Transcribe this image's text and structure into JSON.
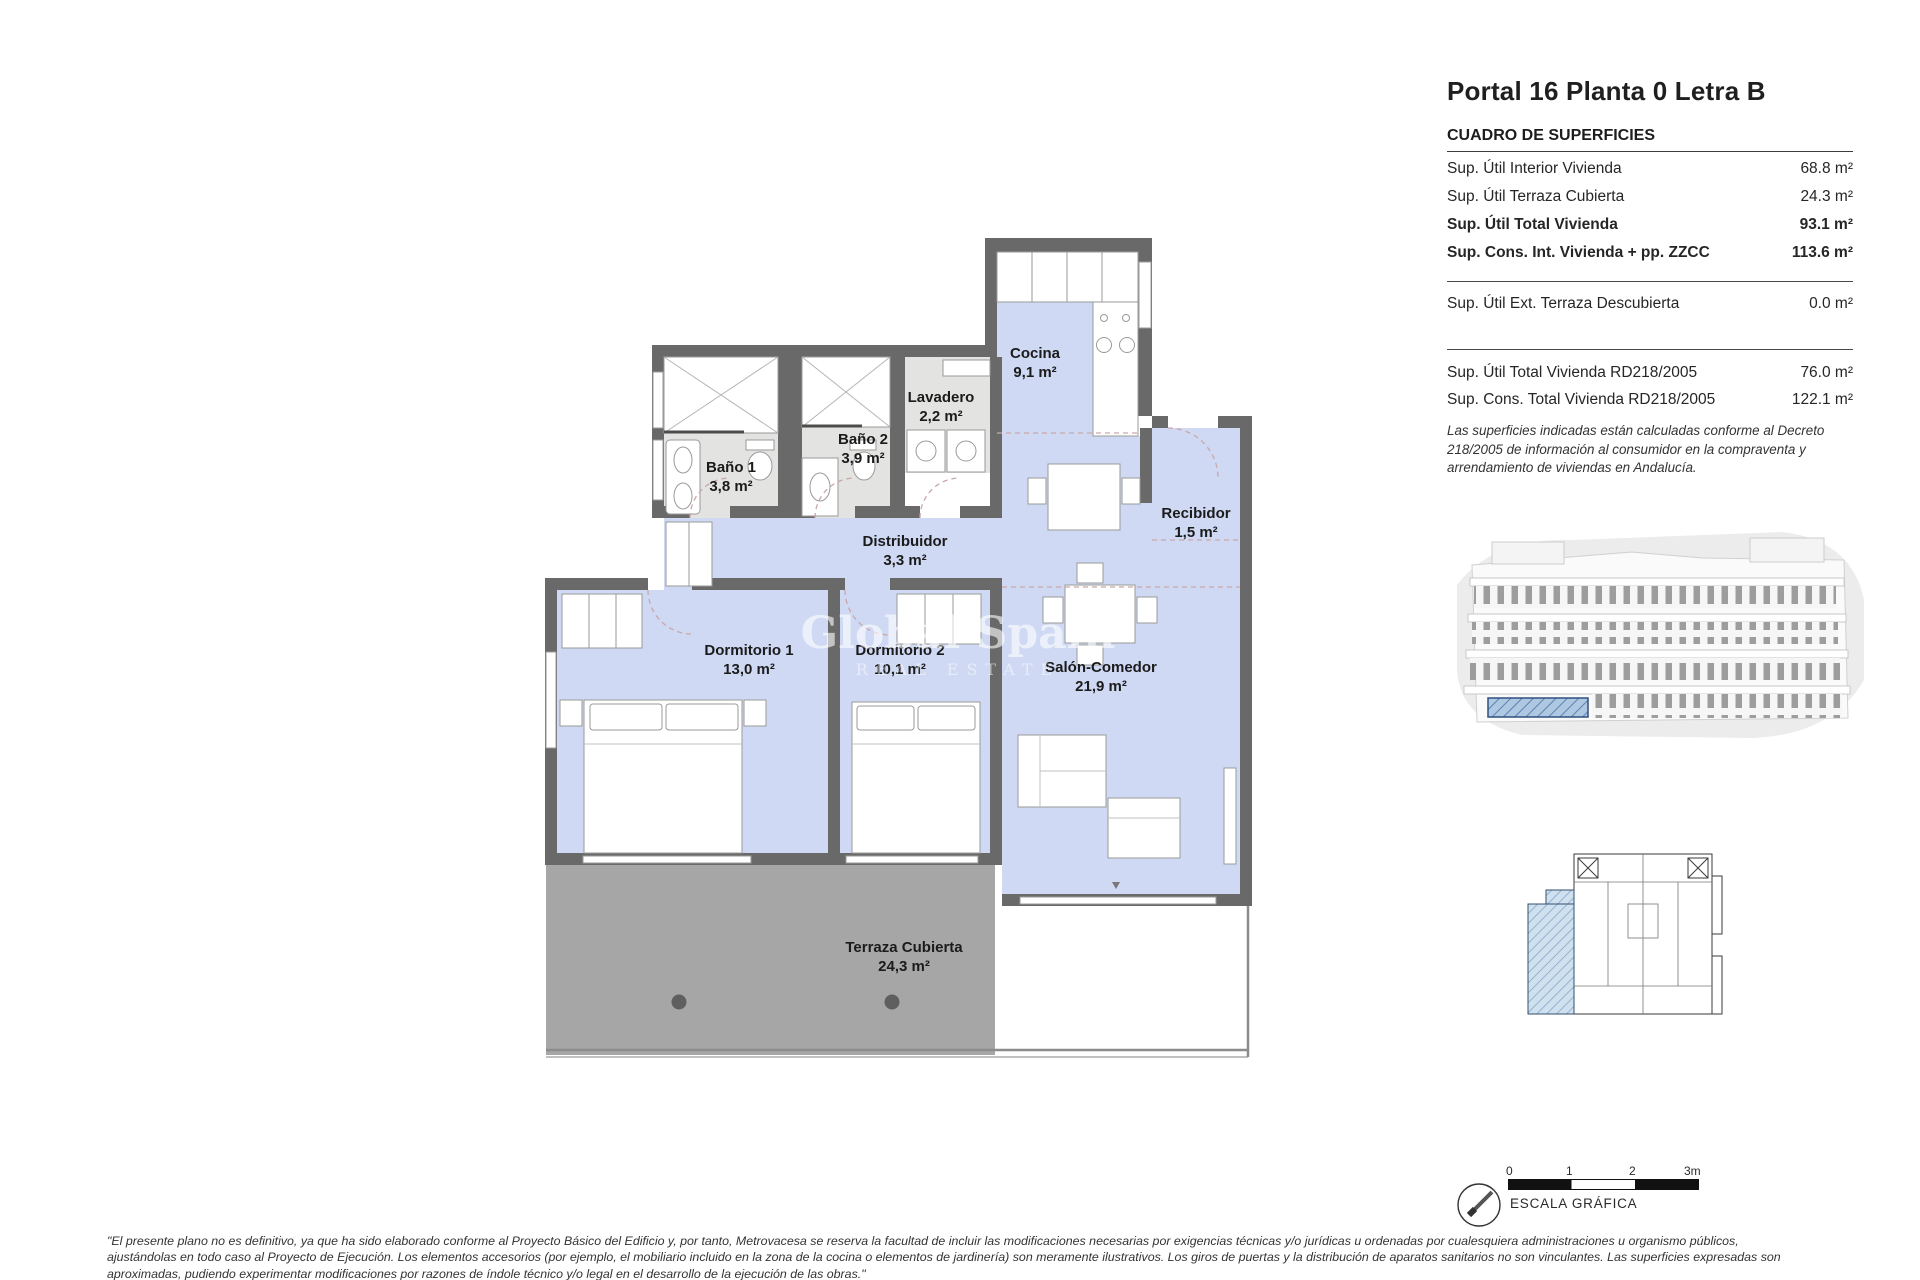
{
  "header": {
    "title": "Portal 16 Planta 0 Letra B"
  },
  "surfaces": {
    "heading": "CUADRO DE SUPERFICIES",
    "rows": [
      {
        "label": "Sup. Útil Interior Vivienda",
        "value": "68.8 m²"
      },
      {
        "label": "Sup. Útil Terraza Cubierta",
        "value": "24.3 m²"
      },
      {
        "label": "Sup. Útil Total Vivienda",
        "value": "93.1 m²"
      },
      {
        "label": "Sup. Cons. Int. Vivienda + pp. ZZCC",
        "value": "113.6 m²"
      }
    ],
    "ext_row": {
      "label": "Sup. Útil Ext. Terraza Descubierta",
      "value": "0.0 m²"
    },
    "rd_rows": [
      {
        "label": "Sup. Útil Total Vivienda RD218/2005",
        "value": "76.0 m²"
      },
      {
        "label": "Sup. Cons. Total Vivienda RD218/2005",
        "value": "122.1 m²"
      }
    ],
    "note": "Las superficies indicadas están calculadas conforme al Decreto 218/2005 de información al consumidor en la compraventa y arrendamiento de viviendas en Andalucía."
  },
  "plan": {
    "rooms": [
      {
        "name": "Cocina",
        "area": "9,1 m²"
      },
      {
        "name": "Lavadero",
        "area": "2,2 m²"
      },
      {
        "name": "Baño 1",
        "area": "3,8 m²"
      },
      {
        "name": "Baño 2",
        "area": "3,9 m²"
      },
      {
        "name": "Distribuidor",
        "area": "3,3 m²"
      },
      {
        "name": "Recibidor",
        "area": "1,5 m²"
      },
      {
        "name": "Dormitorio 1",
        "area": "13,0 m²"
      },
      {
        "name": "Dormitorio 2",
        "area": "10,1 m²"
      },
      {
        "name": "Salón-Comedor",
        "area": "21,9 m²"
      },
      {
        "name": "Terraza Cubierta",
        "area": "24,3 m²"
      }
    ],
    "watermark": {
      "line1": "Global Spain",
      "line2": "REAL ESTATE"
    },
    "colors": {
      "room_fill": "#cfd9f3",
      "wet_fill": "#e3e3e1",
      "terrace_fill": "#a6a6a6",
      "wall": "#696969",
      "unit_highlight": "#c6d9ea"
    }
  },
  "scale_bar": {
    "ticks": [
      "0",
      "1",
      "2",
      "3m"
    ],
    "label": "ESCALA GRÁFICA"
  },
  "footer": {
    "lines": [
      "\"El presente plano no es definitivo, ya que ha sido elaborado conforme al Proyecto Básico del Edificio y, por tanto, Metrovacesa se reserva la facultad de incluir las modificaciones necesarias por exigencias técnicas y/o jurídicas u ordenadas por cualesquiera administraciones u organismo públicos,",
      "ajustándolas en todo caso al Proyecto de Ejecución. Los elementos accesorios (por ejemplo, el mobiliario incluido en la zona de la cocina o elementos de jardinería) son meramente ilustrativos. Los giros de puertas y la distribución de aparatos sanitarios no son vinculantes. Las superficies expresadas son",
      "aproximadas, pudiendo experimentar modificaciones por razones de índole técnico y/o legal en el desarrollo de la ejecución de las obras.\""
    ]
  }
}
